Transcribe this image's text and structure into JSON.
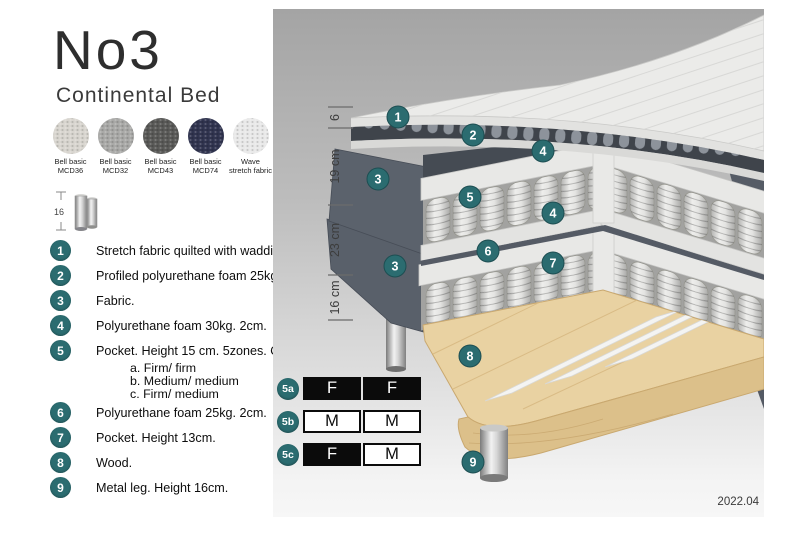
{
  "header": {
    "title": "No3",
    "subtitle": "Continental Bed"
  },
  "swatches": [
    {
      "line1": "Bell basic",
      "line2": "MCD36",
      "color": "#d8d5cf"
    },
    {
      "line1": "Bell basic",
      "line2": "MCD32",
      "color": "#a9a9a7"
    },
    {
      "line1": "Bell basic",
      "line2": "MCD43",
      "color": "#595957"
    },
    {
      "line1": "Bell basic",
      "line2": "MCD74",
      "color": "#30344f"
    },
    {
      "line1": "Wave",
      "line2": "stretch fabric",
      "color": "#e9e9e9"
    }
  ],
  "leg_icon": {
    "label": "16"
  },
  "legend": {
    "items": [
      {
        "num": "1",
        "text": "Stretch fabric quilted with wadding."
      },
      {
        "num": "2",
        "text": "Profiled polyurethane foam 25kg. 4cm."
      },
      {
        "num": "3",
        "text": "Fabric."
      },
      {
        "num": "4",
        "text": "Polyurethane foam 30kg. 2cm."
      },
      {
        "num": "5",
        "text": "Pocket. Height 15 cm. 5zones. Option:",
        "options": [
          "a. Firm/ firm",
          "b. Medium/ medium",
          "c. Firm/ medium"
        ]
      },
      {
        "num": "6",
        "text": "Polyurethane foam 25kg. 2cm."
      },
      {
        "num": "7",
        "text": "Pocket. Height 13cm."
      },
      {
        "num": "8",
        "text": "Wood."
      },
      {
        "num": "9",
        "text": "Metal leg. Height 16cm."
      }
    ]
  },
  "diagram": {
    "dimensions": [
      "6",
      "19 cm",
      "23 cm",
      "16 cm"
    ],
    "markers": [
      "1",
      "2",
      "4",
      "3",
      "5",
      "4",
      "6",
      "7",
      "3",
      "8",
      "9"
    ]
  },
  "firmness": {
    "rows": [
      {
        "badge": "5a",
        "cells": [
          {
            "label": "F",
            "filled": true
          },
          {
            "label": "F",
            "filled": true
          }
        ]
      },
      {
        "badge": "5b",
        "cells": [
          {
            "label": "M",
            "filled": false
          },
          {
            "label": "M",
            "filled": false
          }
        ]
      },
      {
        "badge": "5c",
        "cells": [
          {
            "label": "F",
            "filled": true
          },
          {
            "label": "M",
            "filled": false
          }
        ]
      }
    ]
  },
  "footer": {
    "version": "2022.04"
  },
  "colors": {
    "accent_teal": "#2b6c70",
    "table_black": "#0b0b0b",
    "fabric_gray": "#59606a",
    "wood": "#e9d2a2"
  }
}
